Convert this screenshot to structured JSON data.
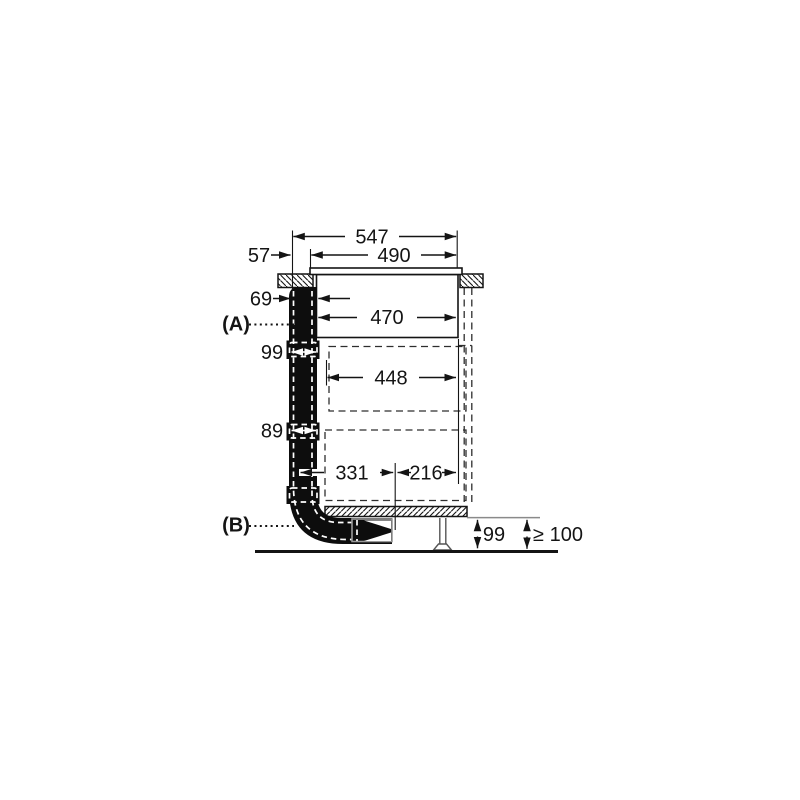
{
  "diagram": {
    "type": "appliance-installation-side-view",
    "ink_color": "#141414",
    "callout_a": "(A)",
    "callout_b": "(B)",
    "dims": {
      "total_top": "547",
      "glass": "490",
      "front": "57",
      "duct_top": "69",
      "body": "470",
      "duct_upper": "99",
      "inner": "448",
      "duct_lower": "89",
      "bottom_left": "331",
      "bottom_right": "216",
      "plinth": "99",
      "clearance": "≥ 100"
    }
  }
}
